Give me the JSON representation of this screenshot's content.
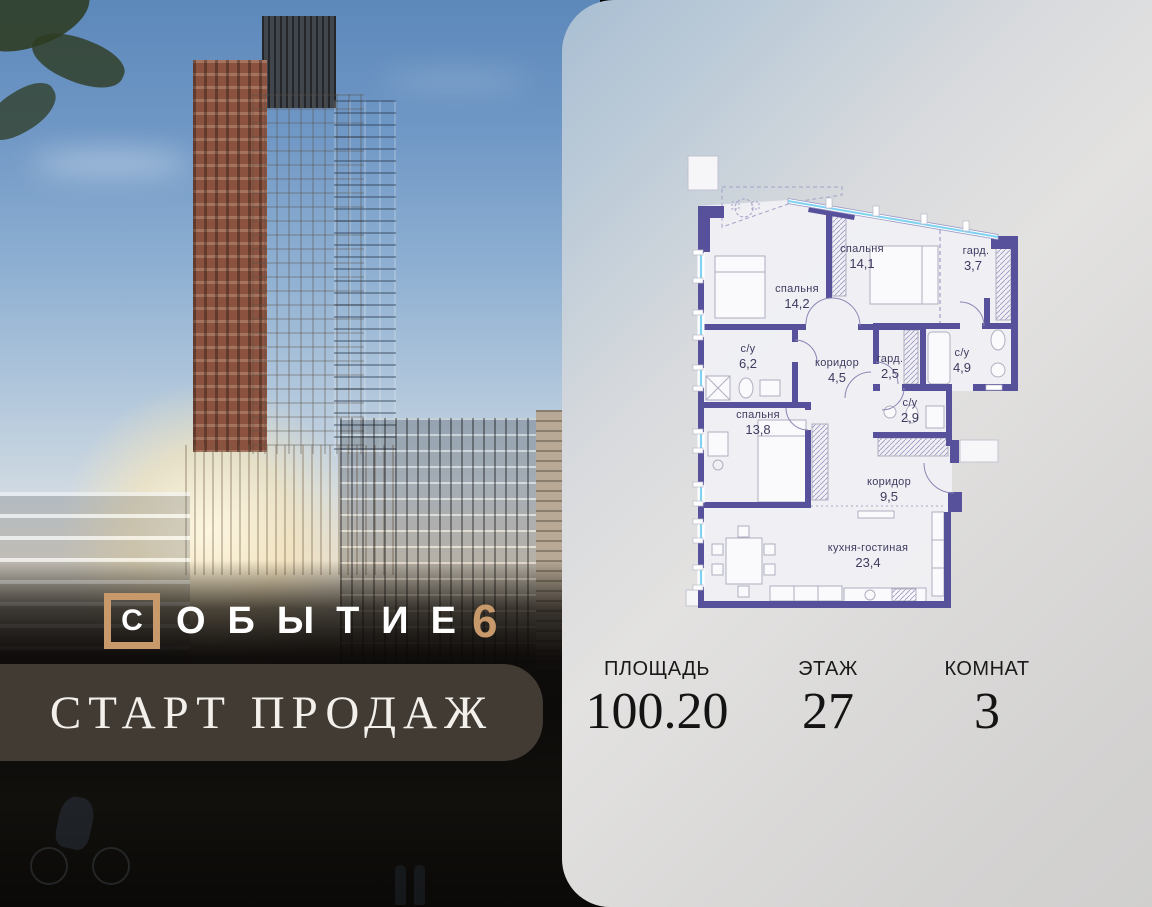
{
  "brand": {
    "boxed_letter": "С",
    "name_rest": "ОБЫТИЕ",
    "number": "6"
  },
  "banner": {
    "text": "СТАРТ ПРОДАЖ"
  },
  "stats": [
    {
      "label": "ПЛОЩАДЬ",
      "value": "100.20"
    },
    {
      "label": "ЭТАЖ",
      "value": "27"
    },
    {
      "label": "КОМНАТ",
      "value": "3"
    }
  ],
  "floorplan": {
    "rooms": [
      {
        "name": "спальня",
        "area": "14,1"
      },
      {
        "name": "гард.",
        "area": "3,7"
      },
      {
        "name": "спальня",
        "area": "14,2"
      },
      {
        "name": "с/у",
        "area": "6,2"
      },
      {
        "name": "коридор",
        "area": "4,5"
      },
      {
        "name": "гард.",
        "area": "2,5"
      },
      {
        "name": "с/у",
        "area": "4,9"
      },
      {
        "name": "с/у",
        "area": "2,9"
      },
      {
        "name": "спальня",
        "area": "13,8"
      },
      {
        "name": "коридор",
        "area": "9,5"
      },
      {
        "name": "кухня-гостиная",
        "area": "23,4"
      }
    ]
  },
  "colors": {
    "wall": "#56519A",
    "window_glass": "#7FD3F1",
    "gold": "#C8996A",
    "banner_bg": "#443D36",
    "plan_label": "#3E3B60"
  }
}
